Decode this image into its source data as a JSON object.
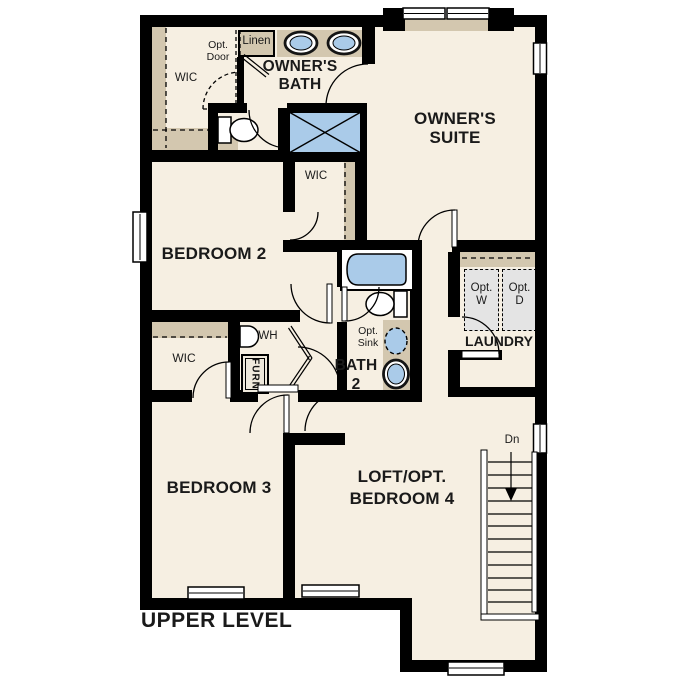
{
  "title": "UPPER LEVEL",
  "colors": {
    "floor": "#f6efe2",
    "wall": "#000000",
    "shelf_tan": "#d3c7af",
    "fixture_blue": "#aacbe9",
    "appliance_gray": "#e4e4e4",
    "line": "#1a1a1a"
  },
  "labels": {
    "wic_owner": "WIC",
    "opt_door": "Opt.\nDoor",
    "linen": "Linen",
    "owners_bath": "OWNER'S\nBATH",
    "owners_suite": "OWNER'S\nSUITE",
    "bedroom2": "BEDROOM 2",
    "wic_bedroom2": "WIC",
    "laundry": "LAUNDRY",
    "opt_washer": "Opt.\nW",
    "opt_dryer": "Opt.\nD",
    "water_heater": "WH",
    "furnace": "FURN",
    "wic_bedroom3": "WIC",
    "opt_sink": "Opt.\nSink",
    "bath2": "BATH\n2",
    "bedroom3": "BEDROOM 3",
    "loft": "LOFT/OPT.\nBEDROOM 4",
    "stairs_direction": "Dn",
    "level": "UPPER LEVEL"
  }
}
